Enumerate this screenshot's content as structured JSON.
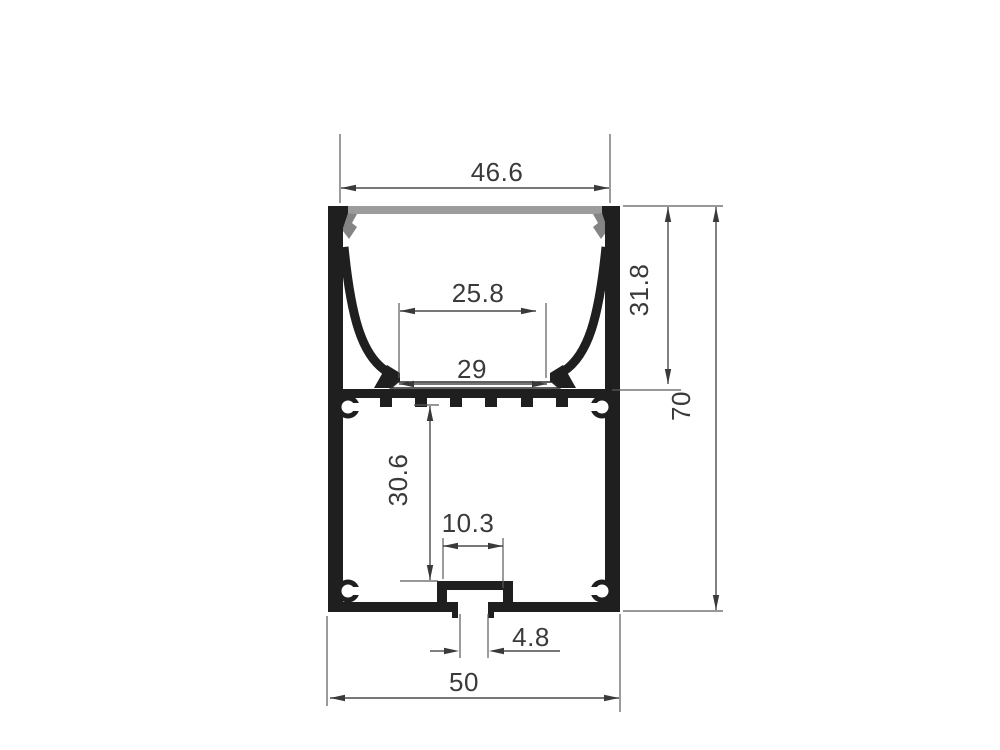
{
  "drawing": {
    "kind": "aluminium-led-profile-cross-section",
    "labels": {
      "top_opening_width": "46.6",
      "inner_shelf_width": "25.8",
      "shelf_width": "29",
      "upper_cavity_depth": "31.8",
      "overall_height": "70",
      "lower_cavity_height": "30.6",
      "screw_slot_inner_width": "10.3",
      "screw_slot_opening": "4.8",
      "overall_width": "50"
    },
    "colors": {
      "profile": "#1f1f1f",
      "diffuser": "#9c9c9c",
      "clip": "#848484",
      "dimension_lines": "#4a4a4a",
      "text": "#3a3a3a",
      "background": "#ffffff"
    }
  }
}
